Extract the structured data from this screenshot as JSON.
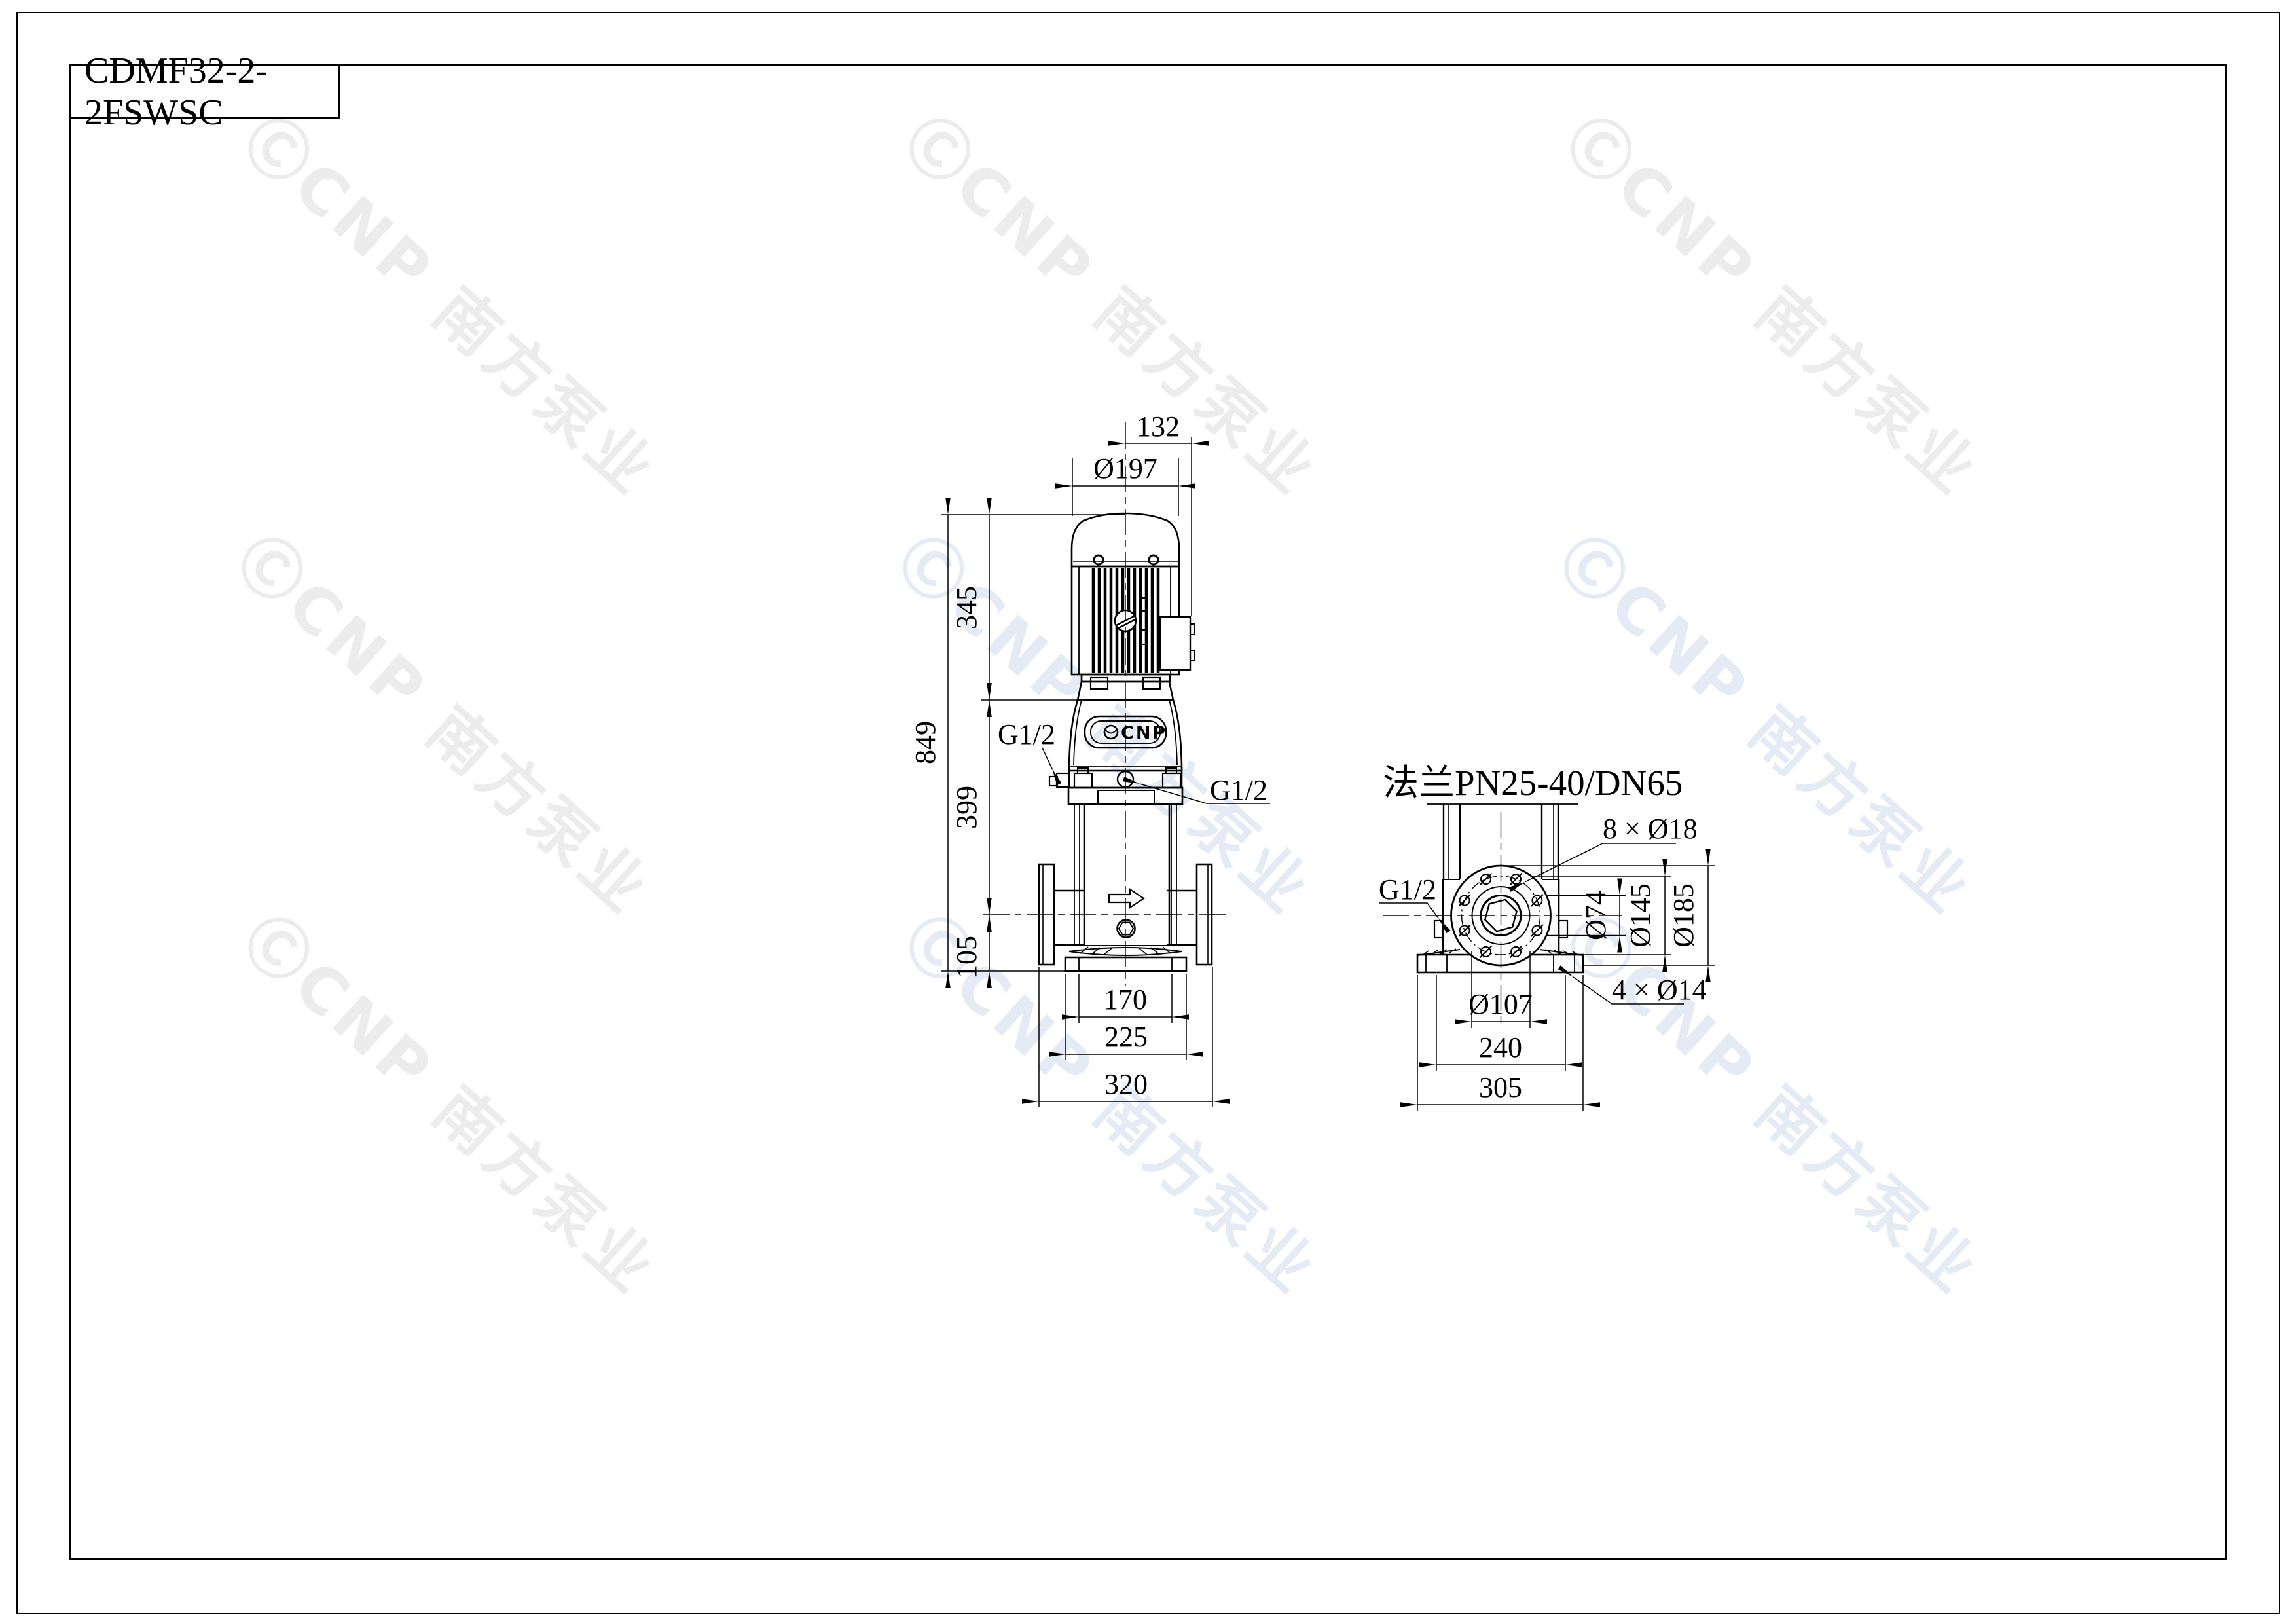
{
  "sheet": {
    "background": "#ffffff",
    "line_color": "#000000"
  },
  "title_block": {
    "model": "CDMF32-2-2FSWSC"
  },
  "watermark": {
    "text": "ⒸCNP 南方泵业",
    "color_gray": "#ececec",
    "color_blue": "#e4ebf5"
  },
  "front_view": {
    "plate_logo": "CNP",
    "dims": {
      "width_top": "132",
      "motor_dia": "Ø197",
      "motor_height": "345",
      "total_height": "849",
      "mid_height": "399",
      "base_height": "105",
      "port_left": "G1/2",
      "port_right": "G1/2",
      "foot_width": "170",
      "base_width": "225",
      "port_span": "320"
    }
  },
  "side_view": {
    "section_title": "法兰PN25-40/DN65",
    "dims": {
      "flange_bolt_holes": "8 × Ø18",
      "drain_port": "G1/2",
      "bore_dia": "Ø74",
      "bolt_circle_dia": "Ø145",
      "flange_od": "Ø185",
      "raised_face_dia": "Ø107",
      "base_holes": "4 × Ø14",
      "base_bolt_span": "240",
      "base_width": "305"
    }
  }
}
